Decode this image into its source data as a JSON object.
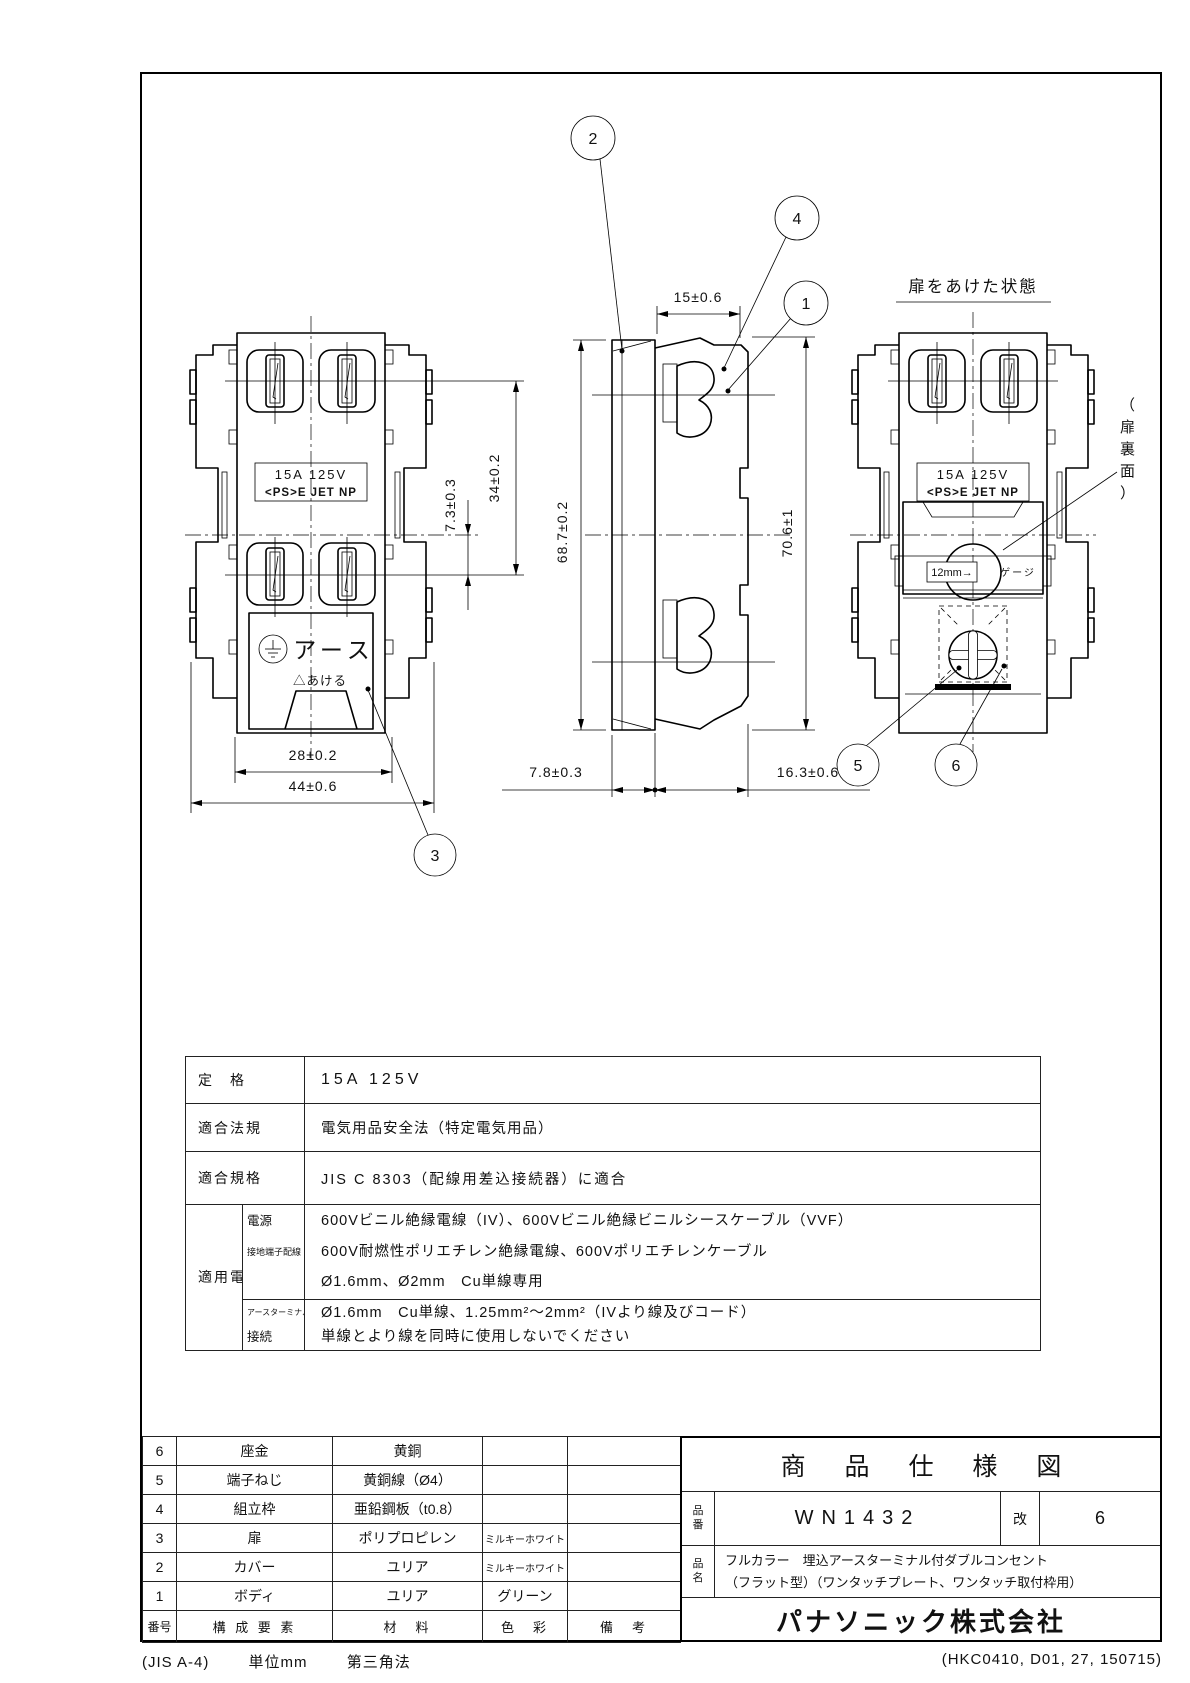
{
  "drawing": {
    "views": {
      "front": {
        "rating_line1": "15A 125V",
        "rating_line2": "<PS>E JET NP",
        "earth_label": "アース",
        "open_label": "△あける"
      },
      "door_open": {
        "title": "扉をあけた状態",
        "rating_line1": "15A 125V",
        "rating_line2": "<PS>E JET NP",
        "gauge_value": "12mm→",
        "gauge_label": "ゲージ",
        "door_back_note": [
          "（",
          "扉",
          "裏",
          "面",
          "）"
        ]
      }
    },
    "dimensions": {
      "pin_pitch": "7.3±0.3",
      "socket_span": "34±0.2",
      "cover_width": "28±0.2",
      "frame_width": "44±0.6",
      "depth_top": "15±0.6",
      "height_left": "68.7±0.2",
      "height_right": "70.6±1",
      "depth_front": "7.8±0.3",
      "depth_rear": "16.3±0.6"
    },
    "balloons": {
      "b1": "1",
      "b2": "2",
      "b3": "3",
      "b4": "4",
      "b5": "5",
      "b6": "6"
    }
  },
  "spec_table": {
    "rows": [
      {
        "label": "定　格",
        "value": "15A 125V"
      },
      {
        "label": "適合法規",
        "value": "電気用品安全法（特定電気用品）"
      },
      {
        "label": "適合規格",
        "value": "JIS C 8303（配線用差込接続器）に適合"
      }
    ],
    "wire": {
      "label": "適用電線",
      "sub1_label_1": "電源",
      "sub1_label_2": "接地端子配線",
      "sub1_lines": [
        "600Vビニル絶縁電線（IV）、600Vビニル絶縁ビニルシースケーブル（VVF）",
        "600V耐燃性ポリエチレン絶縁電線、600Vポリエチレンケーブル",
        "Ø1.6mm、Ø2mm　Cu単線専用"
      ],
      "sub2_label_1": "アースターミナル",
      "sub2_label_2": "接続",
      "sub2_lines": [
        "Ø1.6mm　Cu単線、1.25mm²～2mm²（IVより線及びコード）",
        "単線とより線を同時に使用しないでください"
      ]
    }
  },
  "parts_table": {
    "headers": {
      "no": "番号",
      "component": "構 成 要 素",
      "material": "材　料",
      "color": "色　彩",
      "remarks": "備　考"
    },
    "rows": [
      {
        "no": "6",
        "component": "座金",
        "material": "黄銅",
        "color": "",
        "remarks": ""
      },
      {
        "no": "5",
        "component": "端子ねじ",
        "material": "黄銅線（Ø4）",
        "color": "",
        "remarks": ""
      },
      {
        "no": "4",
        "component": "組立枠",
        "material": "亜鉛鋼板（t0.8）",
        "color": "",
        "remarks": ""
      },
      {
        "no": "3",
        "component": "扉",
        "material": "ポリプロピレン",
        "color": "ミルキーホワイト",
        "remarks": ""
      },
      {
        "no": "2",
        "component": "カバー",
        "material": "ユリア",
        "color": "ミルキーホワイト",
        "remarks": ""
      },
      {
        "no": "1",
        "component": "ボディ",
        "material": "ユリア",
        "color": "グリーン",
        "remarks": ""
      }
    ]
  },
  "title_block": {
    "doc_title": "商 品 仕 様 図",
    "part_no_label": "品番",
    "part_no": "WN1432",
    "rev_label": "改",
    "rev": "6",
    "name_label": "品名",
    "name_line1": "フルカラー　埋込アースターミナル付ダブルコンセント",
    "name_line2": "（フラット型）（ワンタッチプレート、ワンタッチ取付枠用）",
    "company": "パナソニック株式会社"
  },
  "footer": {
    "left_1": "(JIS A-4)",
    "left_2": "単位mm",
    "left_3": "第三角法",
    "right": "(HKC0410, D01, 27, 150715)"
  }
}
